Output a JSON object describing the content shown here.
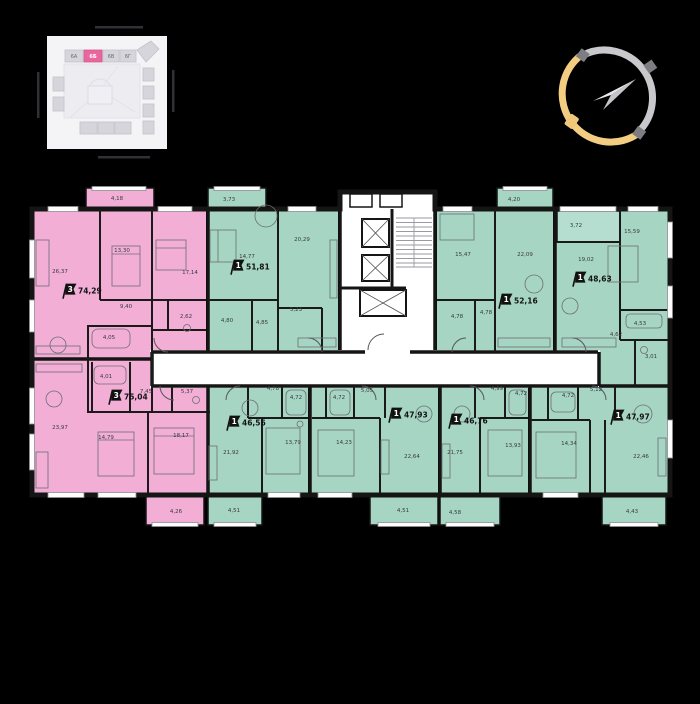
{
  "site_map": {
    "highlighted_building": "6Б",
    "buildings": [
      {
        "label": "6А",
        "highlighted": false
      },
      {
        "label": "6Б",
        "highlighted": true
      },
      {
        "label": "6В",
        "highlighted": false
      },
      {
        "label": "6Г",
        "highlighted": false
      }
    ]
  },
  "icons": {
    "compass": "compass-ring-icon",
    "apartment_flag": "room-count-flag-icon",
    "elevator": "elevator-shaft-icon",
    "stairs": "staircase-icon"
  },
  "colors": {
    "apartment_pink": "#f2aed5",
    "apartment_green": "#a6d5c3",
    "wall": "#151515",
    "compass_yellow": "#f3cd82",
    "compass_gray": "#c9c9cd",
    "map_highlight": "#e9679f"
  },
  "floor_plan": {
    "apartments": [
      {
        "id": "74-29",
        "type": "3",
        "area": "74,29",
        "color": "pink",
        "flag": {
          "x": 64,
          "y": 292
        },
        "rooms": [
          {
            "a": "4,18",
            "x": 117,
            "y": 199
          },
          {
            "a": "26,37",
            "x": 60,
            "y": 272
          },
          {
            "a": "13,30",
            "x": 122,
            "y": 251
          },
          {
            "a": "17,14",
            "x": 190,
            "y": 273
          },
          {
            "a": "9,40",
            "x": 126,
            "y": 307
          },
          {
            "a": "2,62",
            "x": 186,
            "y": 317
          },
          {
            "a": "4,05",
            "x": 109,
            "y": 338
          }
        ]
      },
      {
        "id": "75-04",
        "type": "3",
        "area": "75,04",
        "color": "pink",
        "flag": {
          "x": 110,
          "y": 398
        },
        "rooms": [
          {
            "a": "23,97",
            "x": 60,
            "y": 428
          },
          {
            "a": "14,79",
            "x": 106,
            "y": 438
          },
          {
            "a": "18,17",
            "x": 181,
            "y": 436
          },
          {
            "a": "4,01",
            "x": 106,
            "y": 377
          },
          {
            "a": "7,45",
            "x": 146,
            "y": 392
          },
          {
            "a": "5,37",
            "x": 187,
            "y": 392
          },
          {
            "a": "4,26",
            "x": 176,
            "y": 512
          }
        ]
      },
      {
        "id": "51-81",
        "type": "1",
        "area": "51,81",
        "color": "green",
        "flag": {
          "x": 232,
          "y": 268
        },
        "rooms": [
          {
            "a": "3,73",
            "x": 229,
            "y": 200
          },
          {
            "a": "14,77",
            "x": 247,
            "y": 257
          },
          {
            "a": "20,29",
            "x": 302,
            "y": 240
          },
          {
            "a": "4,80",
            "x": 227,
            "y": 321
          },
          {
            "a": "4,85",
            "x": 262,
            "y": 323
          },
          {
            "a": "5,23",
            "x": 296,
            "y": 310
          }
        ]
      },
      {
        "id": "52-16",
        "type": "1",
        "area": "52,16",
        "color": "green",
        "flag": {
          "x": 500,
          "y": 302
        },
        "rooms": [
          {
            "a": "4,20",
            "x": 514,
            "y": 200
          },
          {
            "a": "15,47",
            "x": 463,
            "y": 255
          },
          {
            "a": "22,09",
            "x": 525,
            "y": 255
          },
          {
            "a": "4,78",
            "x": 457,
            "y": 317
          },
          {
            "a": "4,78",
            "x": 486,
            "y": 313
          }
        ]
      },
      {
        "id": "48-63",
        "type": "1",
        "area": "48,63",
        "color": "green",
        "flag": {
          "x": 574,
          "y": 280
        },
        "rooms": [
          {
            "a": "3,72",
            "x": 576,
            "y": 226
          },
          {
            "a": "19,02",
            "x": 586,
            "y": 260
          },
          {
            "a": "15,59",
            "x": 632,
            "y": 232
          },
          {
            "a": "4,53",
            "x": 640,
            "y": 324
          },
          {
            "a": "4,62",
            "x": 616,
            "y": 335
          },
          {
            "a": "3,01",
            "x": 651,
            "y": 357
          }
        ]
      },
      {
        "id": "46-56",
        "type": "1",
        "area": "46,56",
        "color": "green",
        "flag": {
          "x": 228,
          "y": 424
        },
        "rooms": [
          {
            "a": "4,78",
            "x": 273,
            "y": 389
          },
          {
            "a": "4,72",
            "x": 296,
            "y": 398
          },
          {
            "a": "21,92",
            "x": 231,
            "y": 453
          },
          {
            "a": "13,79",
            "x": 293,
            "y": 443
          },
          {
            "a": "4,51",
            "x": 234,
            "y": 511
          }
        ]
      },
      {
        "id": "47-93",
        "type": "1",
        "area": "47,93",
        "color": "green",
        "flag": {
          "x": 390,
          "y": 416
        },
        "rooms": [
          {
            "a": "4,72",
            "x": 339,
            "y": 398
          },
          {
            "a": "5,05",
            "x": 367,
            "y": 391
          },
          {
            "a": "14,23",
            "x": 344,
            "y": 443
          },
          {
            "a": "22,64",
            "x": 412,
            "y": 457
          },
          {
            "a": "4,51",
            "x": 403,
            "y": 511
          }
        ]
      },
      {
        "id": "46-76",
        "type": "1",
        "area": "46,76",
        "color": "green",
        "flag": {
          "x": 450,
          "y": 422
        },
        "rooms": [
          {
            "a": "4,99",
            "x": 497,
            "y": 389
          },
          {
            "a": "4,72",
            "x": 521,
            "y": 394
          },
          {
            "a": "21,75",
            "x": 455,
            "y": 453
          },
          {
            "a": "13,93",
            "x": 513,
            "y": 446
          },
          {
            "a": "4,58",
            "x": 455,
            "y": 513
          }
        ]
      },
      {
        "id": "47-97",
        "type": "1",
        "area": "47,97",
        "color": "green",
        "flag": {
          "x": 612,
          "y": 418
        },
        "rooms": [
          {
            "a": "4,72",
            "x": 568,
            "y": 396
          },
          {
            "a": "5,12",
            "x": 596,
            "y": 390
          },
          {
            "a": "14,34",
            "x": 569,
            "y": 444
          },
          {
            "a": "22,46",
            "x": 641,
            "y": 457
          },
          {
            "a": "4,43",
            "x": 632,
            "y": 512
          }
        ]
      }
    ]
  }
}
